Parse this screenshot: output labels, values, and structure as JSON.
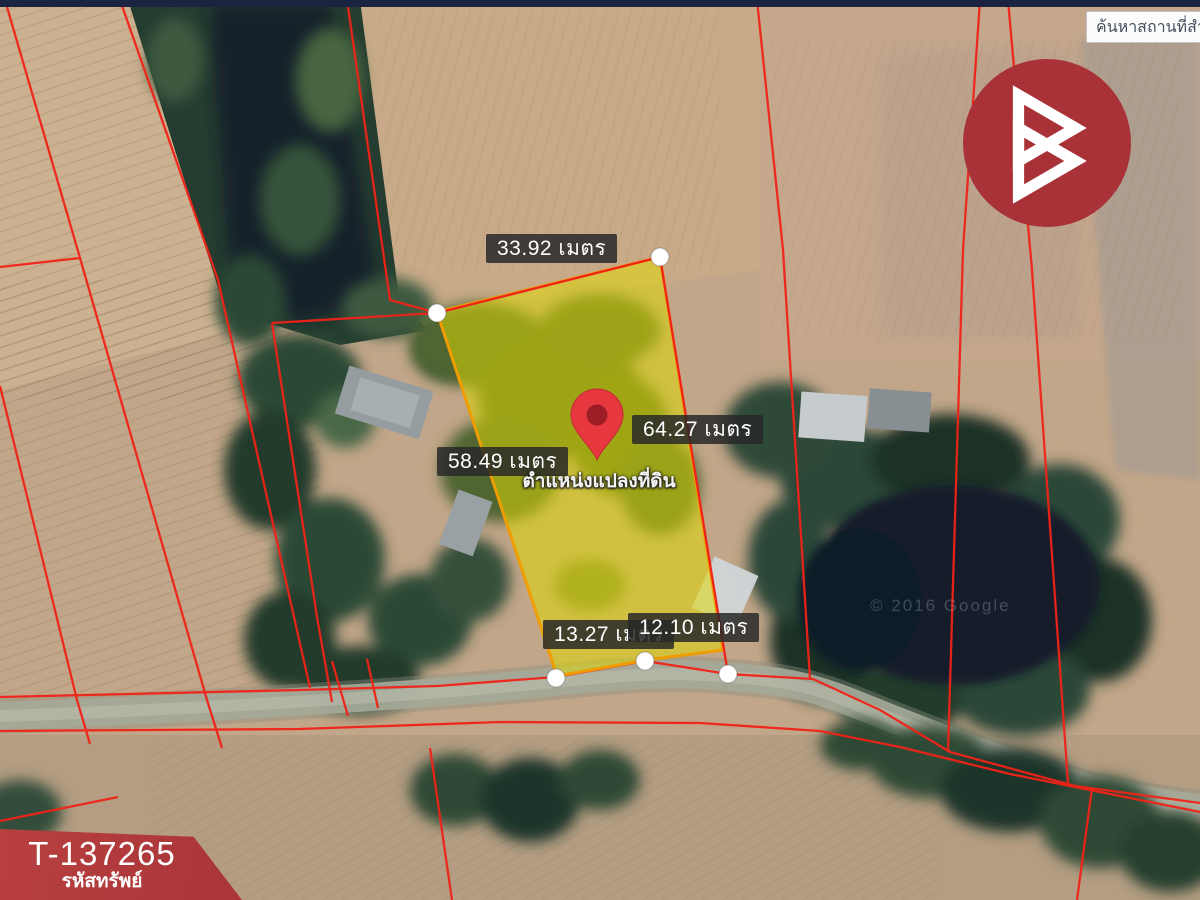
{
  "header": {
    "search_value": "ค้นหาสถานที่สำ"
  },
  "map": {
    "watermark": "© 2016 Google",
    "pin_caption": "ตำแหน่งแปลงที่ดิน",
    "measurements": {
      "top": "33.92 เมตร",
      "right": "64.27 เมตร",
      "left": "58.49 เมตร",
      "bottom_left": "13.27 เมตร",
      "bottom_right": "12.10 เมตร"
    }
  },
  "badge": {
    "code": "T-137265",
    "label": "รหัสทรัพย์"
  },
  "colors": {
    "banner_red": "#b23c3e",
    "logo_red": "#a93138",
    "plot_fill": "#e0da00",
    "plot_stroke": "#ef9d00",
    "boundary_red": "#f02318",
    "topbar_navy": "#1a2440"
  }
}
